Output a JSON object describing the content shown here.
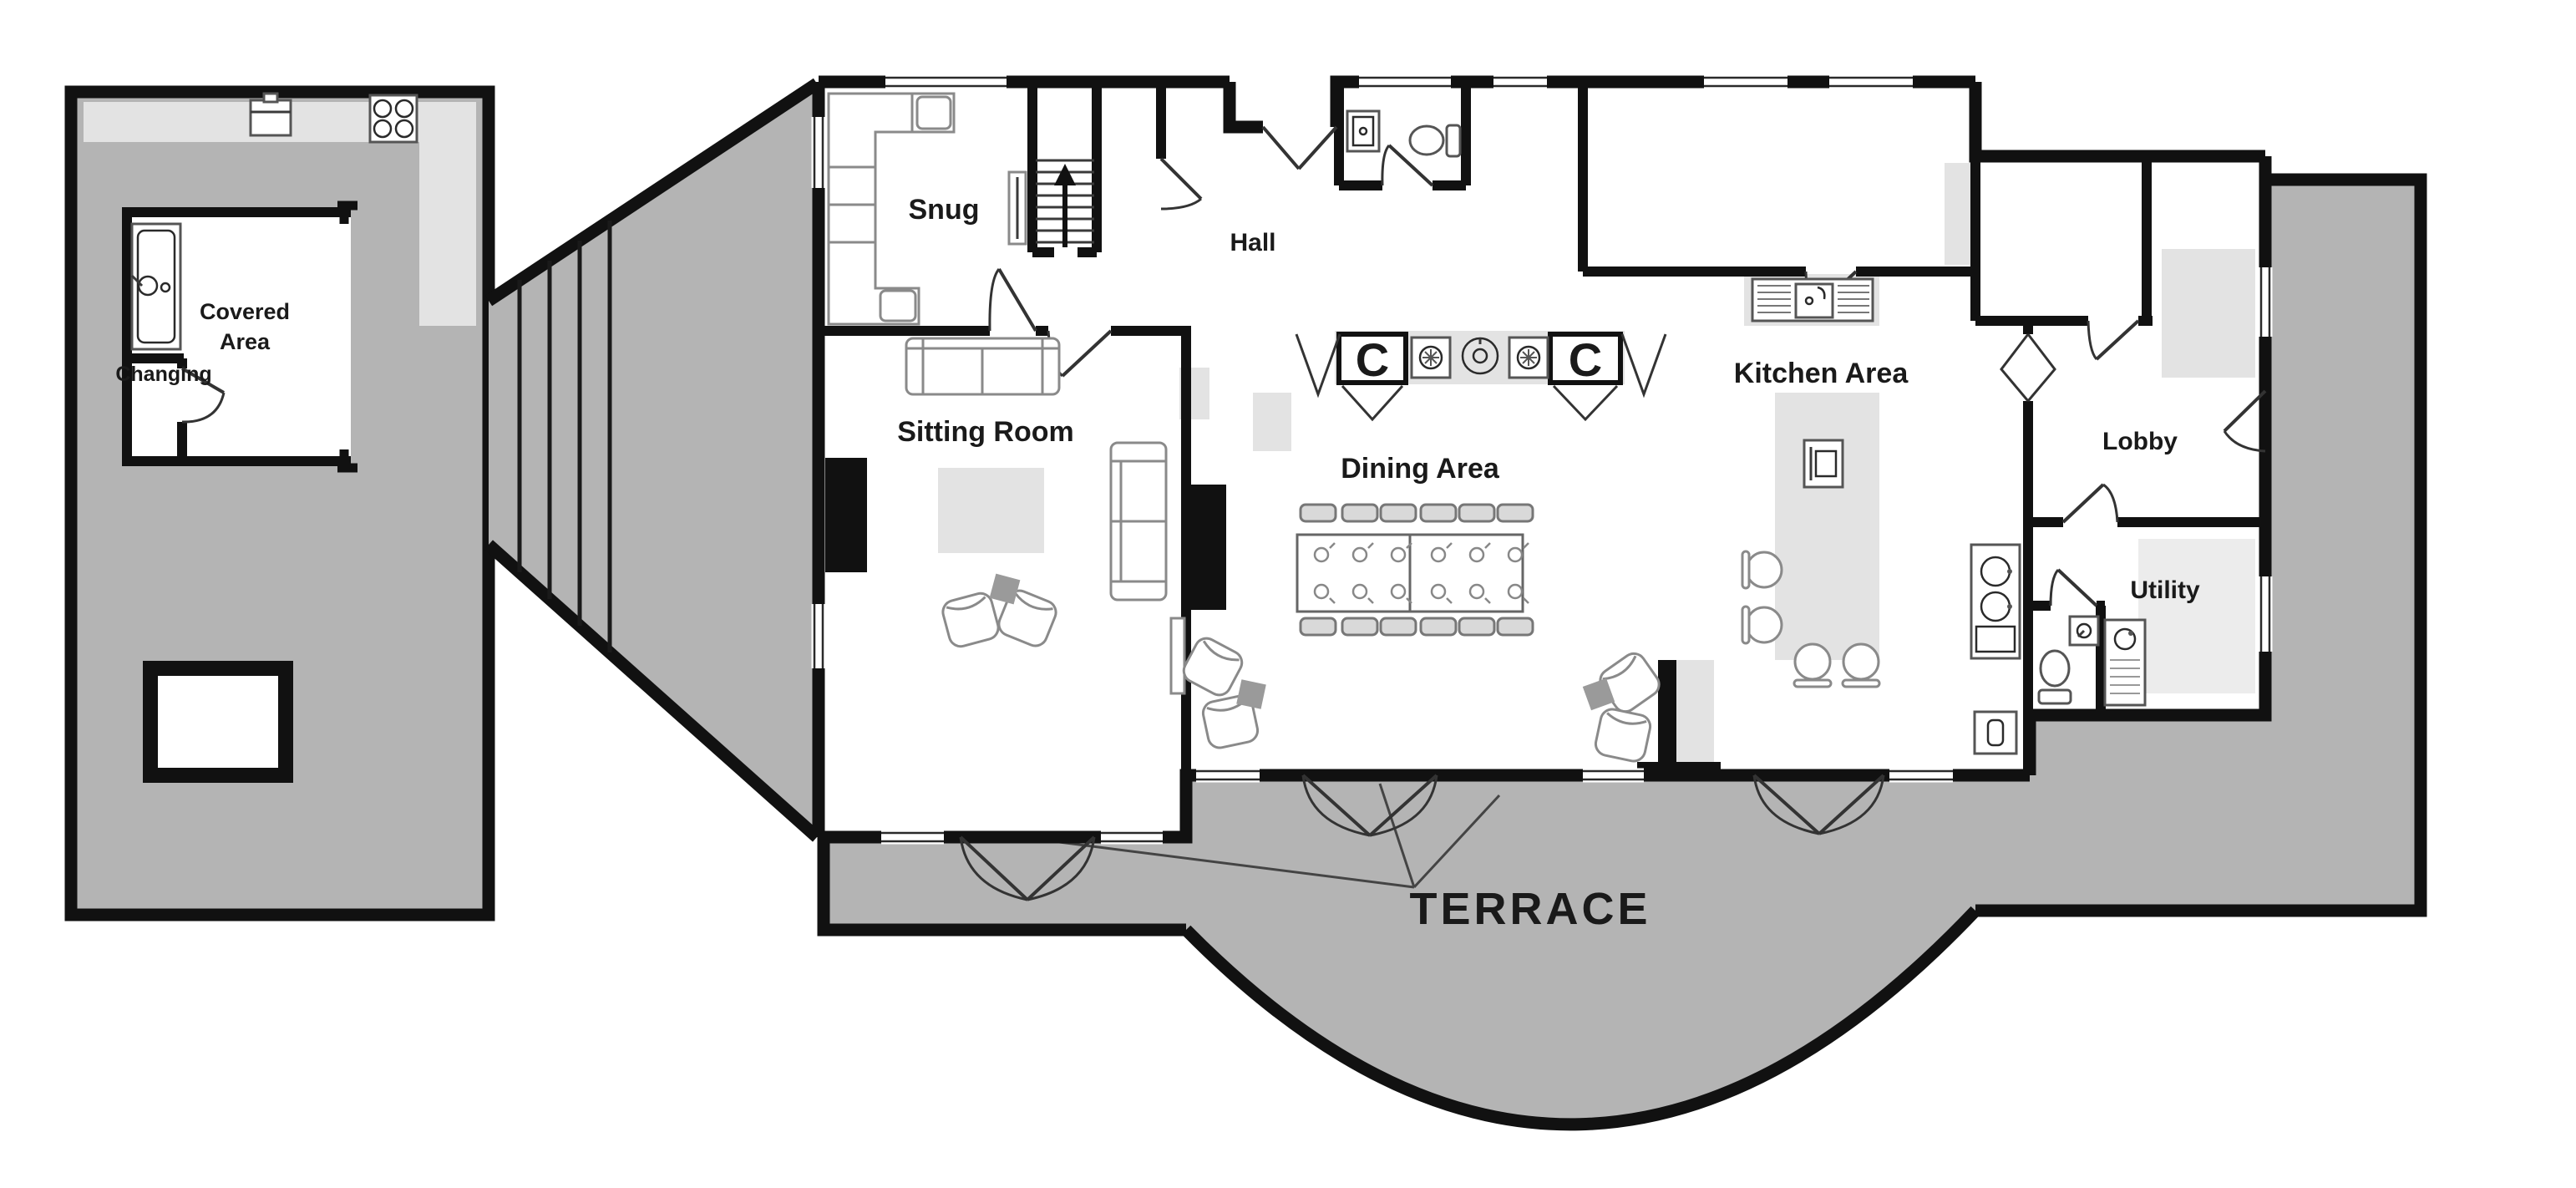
{
  "plan": {
    "labels": {
      "snug": "Snug",
      "hall": "Hall",
      "sitting_room": "Sitting Room",
      "dining_area": "Dining Area",
      "kitchen_area": "Kitchen Area",
      "lobby": "Lobby",
      "utility": "Utility",
      "covered_line1": "Covered",
      "covered_line2": "Area",
      "changing": "Changing",
      "terrace": "TERRACE",
      "cupboard_left": "C",
      "cupboard_right": "C"
    },
    "colors": {
      "wall": "#111111",
      "terrace_gray": "#b4b4b4",
      "accent_light_gray": "#e3e3e3",
      "background": "#ffffff",
      "furniture_stroke": "#8a8a8a",
      "text": "#1a1a1a"
    }
  }
}
